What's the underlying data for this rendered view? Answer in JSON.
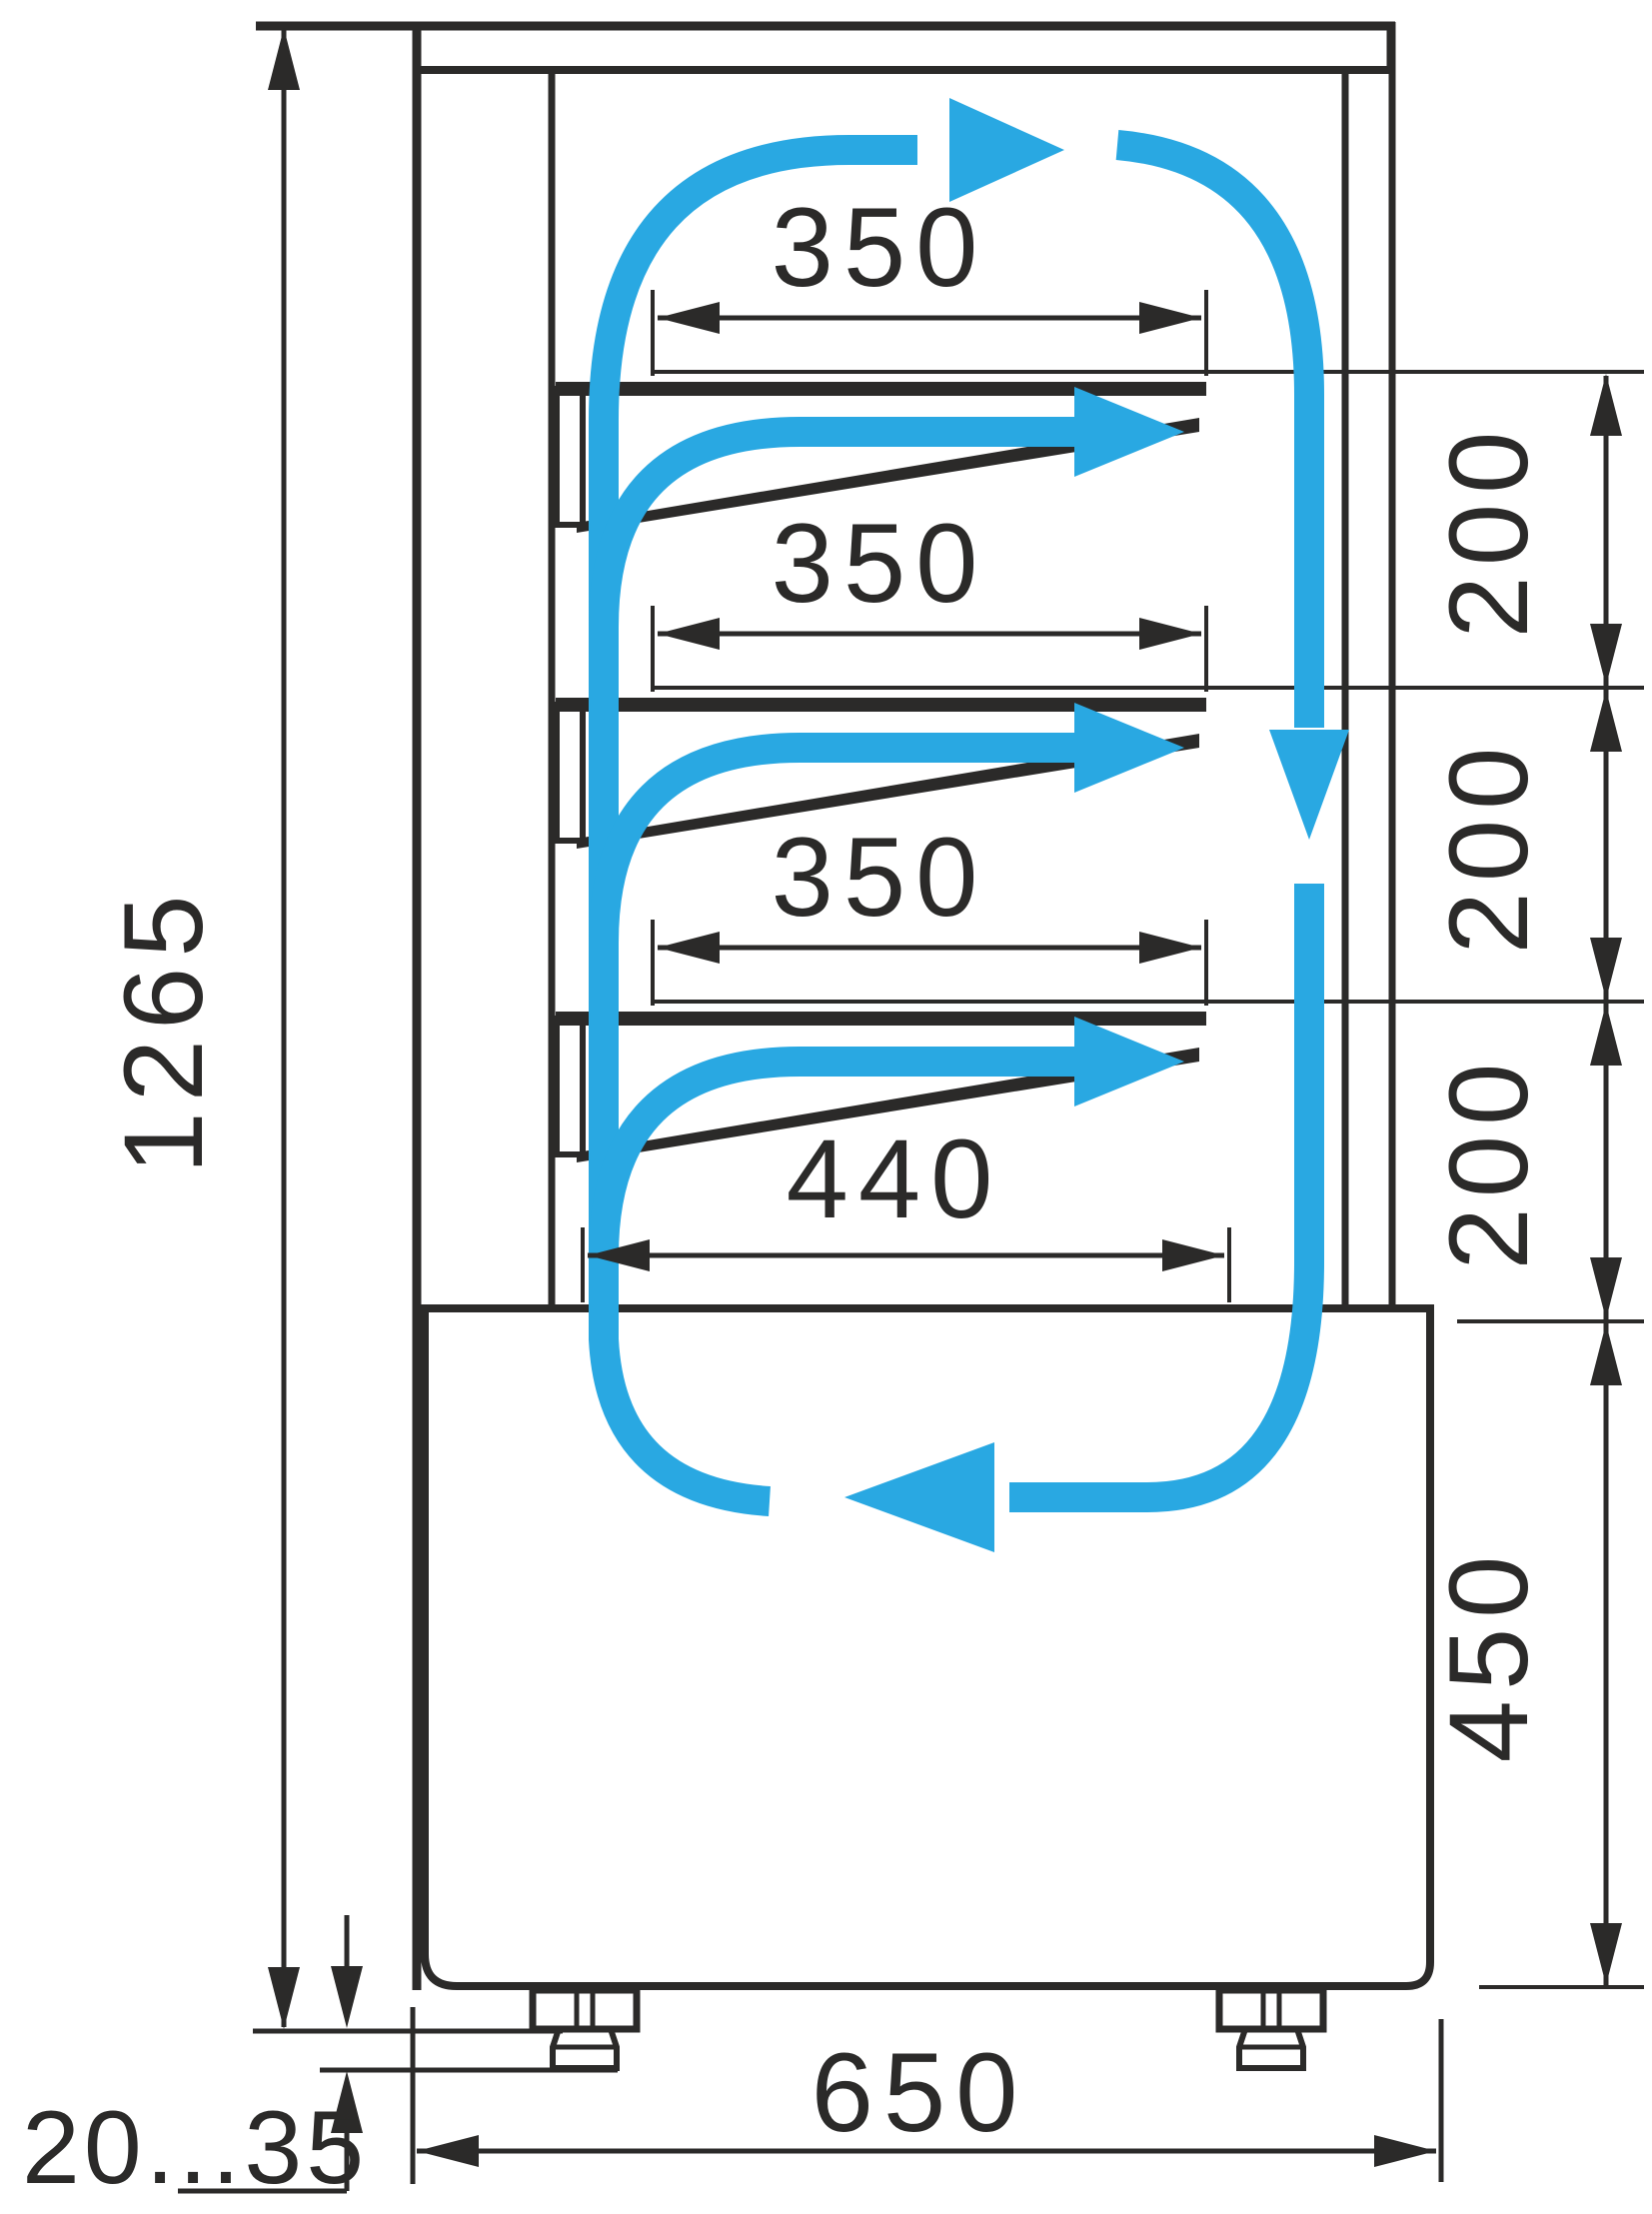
{
  "diagram": {
    "type": "technical-drawing",
    "subject": "refrigerated confectionery display case - side section with air circulation",
    "colors": {
      "line": "#2b2a29",
      "flow": "#29a8e2",
      "background": "#ffffff"
    },
    "labels": {
      "shelf_width_1": "350",
      "shelf_width_2": "350",
      "shelf_width_3": "350",
      "bottom_shelf_width": "440",
      "spacing_1": "200",
      "spacing_2": "200",
      "spacing_3": "200",
      "base_section_height": "450",
      "overall_height": "1265",
      "base_width": "650",
      "foot_adjustment_range": "20...35"
    }
  }
}
